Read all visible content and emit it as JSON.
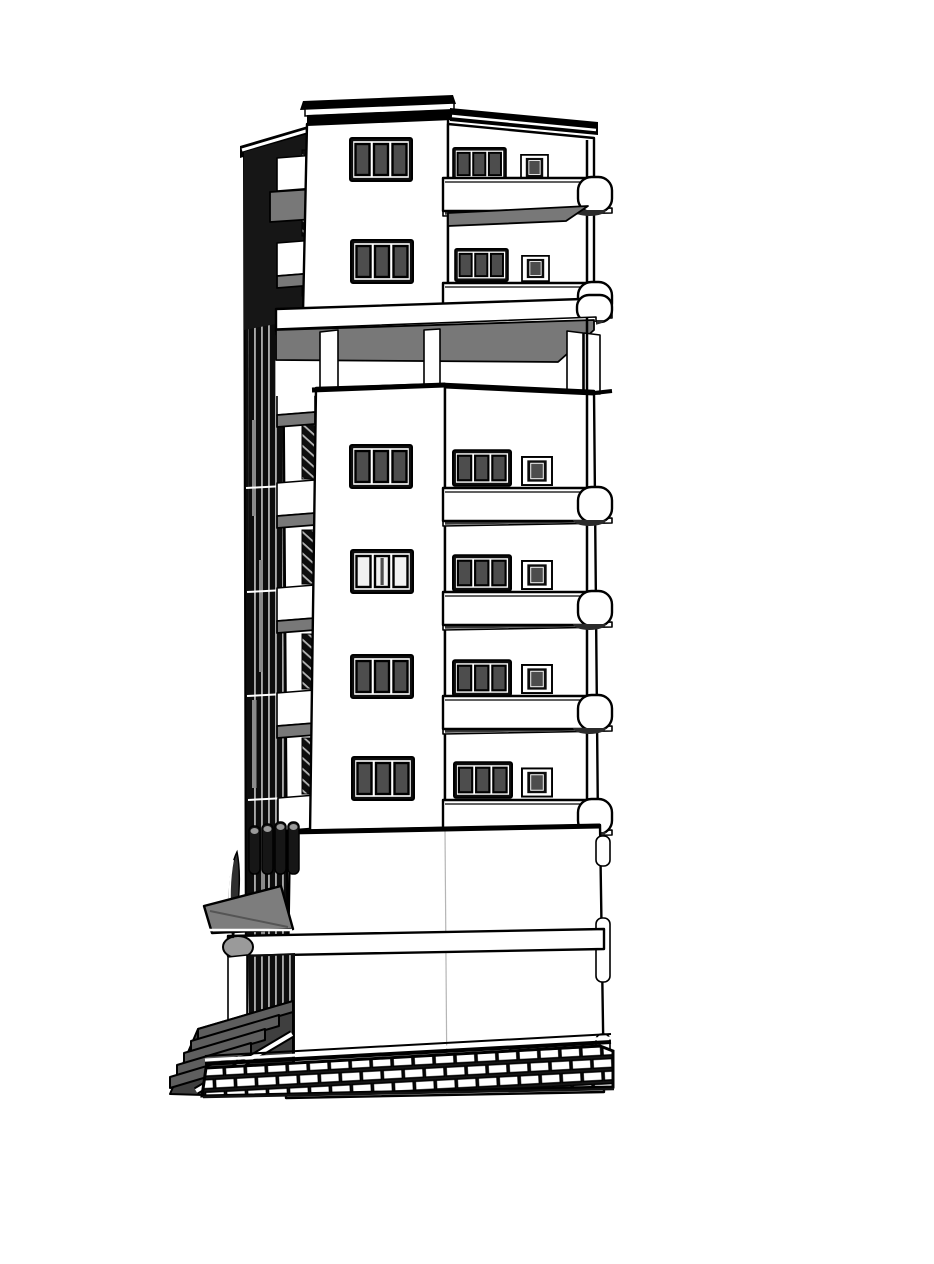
{
  "meta": {
    "title": "Monochrome 3D architectural model of a multi-storey tower building, SketchUp-style line render, two-point perspective from lower left",
    "background": "#ffffff",
    "image_size": {
      "width": 934,
      "height": 1264
    }
  },
  "colors": {
    "background": "#ffffff",
    "line": "#000000",
    "wall": "#ffffff",
    "soffit": "#787878",
    "glass": "#4d4d4d",
    "glass_light": "#f1f1f1",
    "cap_shadow": "#2b2b2b",
    "recess": "#0d0d0d",
    "facade_dark": "#161616",
    "steps_top": "#5e5e5e",
    "steps_side": "#3f3f3f",
    "awning": "#7d7d7d",
    "highlight": "#9a9a9a"
  },
  "building": {
    "style": "black-and-white hidden-line render with flat grey shading",
    "sections": [
      {
        "name": "penthouse-block",
        "floors": 2,
        "front_windows": 2,
        "side_window_groups": 2,
        "small_side_windows": 2,
        "balcony_bands": 2
      },
      {
        "name": "recessed-terrace-floor",
        "columns": 3,
        "soffit": "grey shaded ceiling"
      },
      {
        "name": "main-tower",
        "floors": 4,
        "front_windows": 4,
        "side_window_groups": 4,
        "small_side_windows": 4,
        "balcony_bands": 4
      },
      {
        "name": "podium",
        "floors": 2,
        "features": [
          "entrance canopy",
          "porch columns",
          "edge brackets",
          "floor slab band"
        ]
      },
      {
        "name": "base",
        "features": [
          "stone block retaining wall",
          "entry steps",
          "stair railing"
        ],
        "brick_rows": 3,
        "step_count": 5
      }
    ],
    "window_style": "three-pane windows with heavy black frames and dark glazing; small square side windows",
    "balcony_style": "white slab bands with rounded drum ends and dark undersides on the right facade",
    "left_facade": "deeply shadowed stacked balconies with thin railing balusters and louvered fins",
    "counts": {
      "front_windows_total": 6,
      "side_window_groups_total": 6,
      "small_windows_total": 6,
      "balcony_bands_total": 6,
      "left_balcony_boxes": 7
    }
  }
}
